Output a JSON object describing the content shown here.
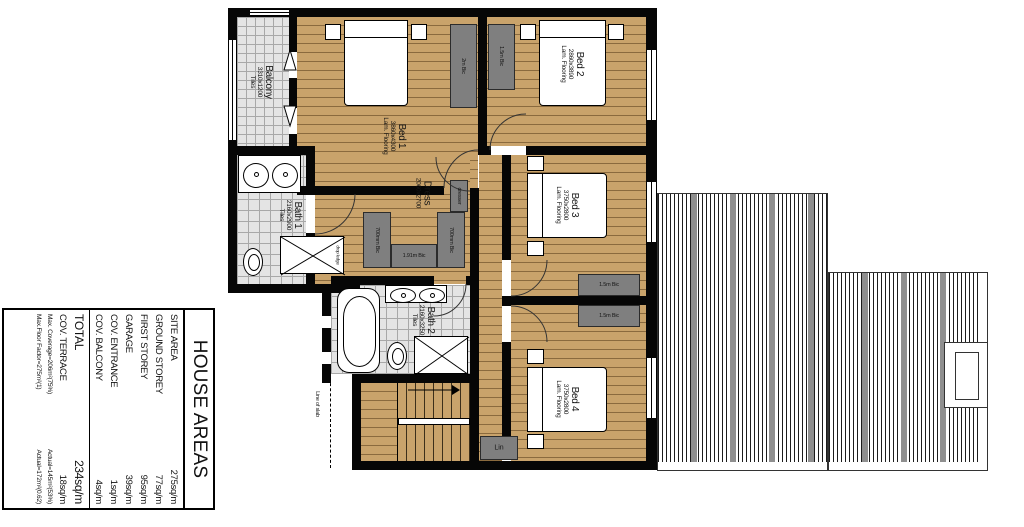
{
  "table": {
    "title": "HOUSE AREAS",
    "rows": [
      {
        "label": "SITE AREA",
        "value": "275sq/m"
      },
      {
        "label": "GROUND STOREY",
        "value": "77sq/m"
      },
      {
        "label": "FIRST STOREY",
        "value": "95sq/m"
      },
      {
        "label": "GARAGE",
        "value": "39sq/m"
      },
      {
        "label": "COV. ENTRANCE",
        "value": "1sq/m"
      },
      {
        "label": "COV. BALCONY",
        "value": "4sq/m"
      }
    ],
    "totals": [
      {
        "label": "TOTAL",
        "value": "234sq/m"
      },
      {
        "label": "COV. TERRACE",
        "value": "18sq/m"
      }
    ],
    "footnotes": [
      {
        "left": "Max. Coverage=206m²(75%)",
        "right": "Actual=145m²(53%)"
      },
      {
        "left": "Max.Floor Factor=275m²(1)",
        "right": "Actual=172m²(0.62)"
      }
    ]
  },
  "rooms": {
    "balcony": {
      "name": "Balcony",
      "dims": "3310x1200",
      "floor": "Tiles"
    },
    "bed1": {
      "name": "Bed 1",
      "dims": "3860x4300",
      "floor": "Lam. Flooring"
    },
    "bed2": {
      "name": "Bed 2",
      "dims": "2860x3890",
      "floor": "Lam. Flooring"
    },
    "bed3": {
      "name": "Bed 3",
      "dims": "3750x2800",
      "floor": "Lam. Flooring"
    },
    "bed4": {
      "name": "Bed 4",
      "dims": "3750x2800",
      "floor": "Lam. Flooring"
    },
    "bath1": {
      "name": "Bath 1",
      "dims": "2160x2900",
      "floor": "Tiles"
    },
    "bath2": {
      "name": "Bath 2",
      "dims": "2160x3250",
      "floor": "Tiles"
    },
    "dress": {
      "name": "Dress",
      "dims": "2060x2700"
    }
  },
  "closets": {
    "bed1_robe": "2m Bic",
    "bed2_robe": "1.5m Bic",
    "bed3_robe": "1.5m Bic",
    "bed4_robe": "1.5m Bic",
    "dress_left": "700mm Bic",
    "dress_right": "700mm Bic",
    "dress_bottom": "1.91m Bic",
    "dresser": "dresser",
    "linen": "Lin"
  },
  "annotations": {
    "line_of_slab": "Line of slab",
    "shower_note": "drop ledge"
  },
  "colors": {
    "wood": "#c9a36b",
    "wood_line": "#8a6a3e",
    "tile": "#e4e4e4",
    "wall": "#060606",
    "closet_gray": "#7f7f7f"
  }
}
